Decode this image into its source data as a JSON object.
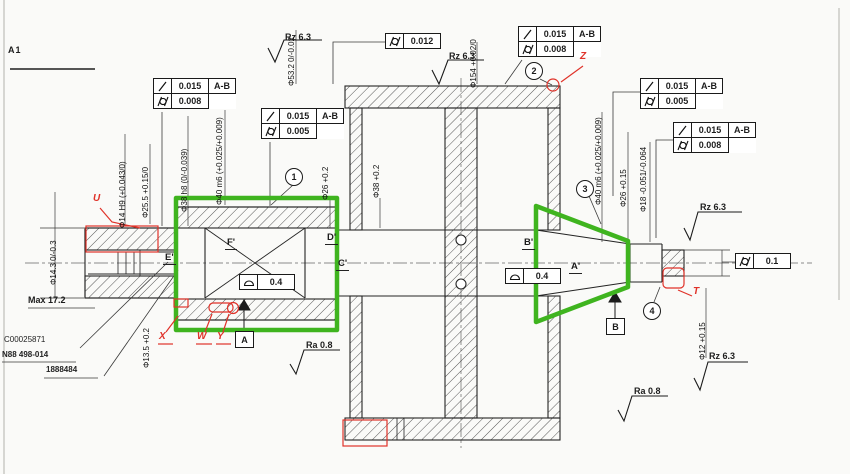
{
  "sheet": {
    "label": "A1"
  },
  "colors": {
    "highlight_green": "#3fb41f",
    "annotation_red": "#e03229"
  },
  "icons": {
    "runout": "slash-runout-icon",
    "cylindricity": "circle-slash-cylindricity-icon",
    "profile": "half-dome-profile-icon",
    "surface_finish": "machined-surface-check-icon"
  },
  "tolerance_frames": {
    "f1": {
      "val1": "0.015",
      "datum": "A-B",
      "val2": "0.008"
    },
    "f2": {
      "val1": "0.015",
      "datum": "A-B",
      "val2": "0.005"
    },
    "f3": {
      "val1": "0.012"
    },
    "f4": {
      "val1": "0.015",
      "datum": "A-B",
      "val2": "0.008"
    },
    "f5": {
      "val1": "0.015",
      "datum": "A-B",
      "val2": "0.005"
    },
    "f6": {
      "val1": "0.015",
      "datum": "A-B",
      "val2": "0.008"
    },
    "f7": {
      "val1": "0.1"
    },
    "f8": {
      "val1": "0.4"
    },
    "f9": {
      "val1": "0.4"
    }
  },
  "surface_finish": {
    "s1": "Rz 6.3",
    "s2": "Rz 6.3",
    "s3": "Rz 6.3",
    "s4": "Rz 6.3",
    "s5": "Ra 0.8",
    "s6": "Ra 0.8"
  },
  "dimensions": {
    "d1": "Φ14.3 0/-0.3",
    "d2": "Φ14 H9 (+0.043/0)",
    "d3": "Φ25.5 +0.15/0",
    "d4": "Φ38 h8 (0/-0.039)",
    "d5": "Φ40 m6 (+0.025/+0.009)",
    "d6": "Φ26 +0.2",
    "d7": "Φ38 +0.2",
    "d8": "Φ53.2 0/-0.02",
    "d9": "Φ154 +0.02/0",
    "d10": "Φ40 m6 (+0.025/+0.009)",
    "d11": "Φ26 +0.15",
    "d12": "Φ18 -0.051/-0.064",
    "d13": "Φ12 +0.15",
    "d14": "Φ13.5 +0.2",
    "d15": "Max 17.2"
  },
  "section_labels": {
    "e": "E'",
    "f": "F'",
    "d": "D'",
    "c": "C'",
    "b": "B'",
    "a": "A'"
  },
  "balloons": {
    "b1": "1",
    "b2": "2",
    "b3": "3",
    "b4": "4"
  },
  "datums": {
    "a": "A",
    "b": "B"
  },
  "red_marks": {
    "u": "U",
    "z": "Z",
    "t": "T",
    "x": "X",
    "w": "W",
    "y": "Y"
  },
  "notes": {
    "line1": "C00025871",
    "line2": "N88 498-014",
    "line3": "1888484"
  }
}
